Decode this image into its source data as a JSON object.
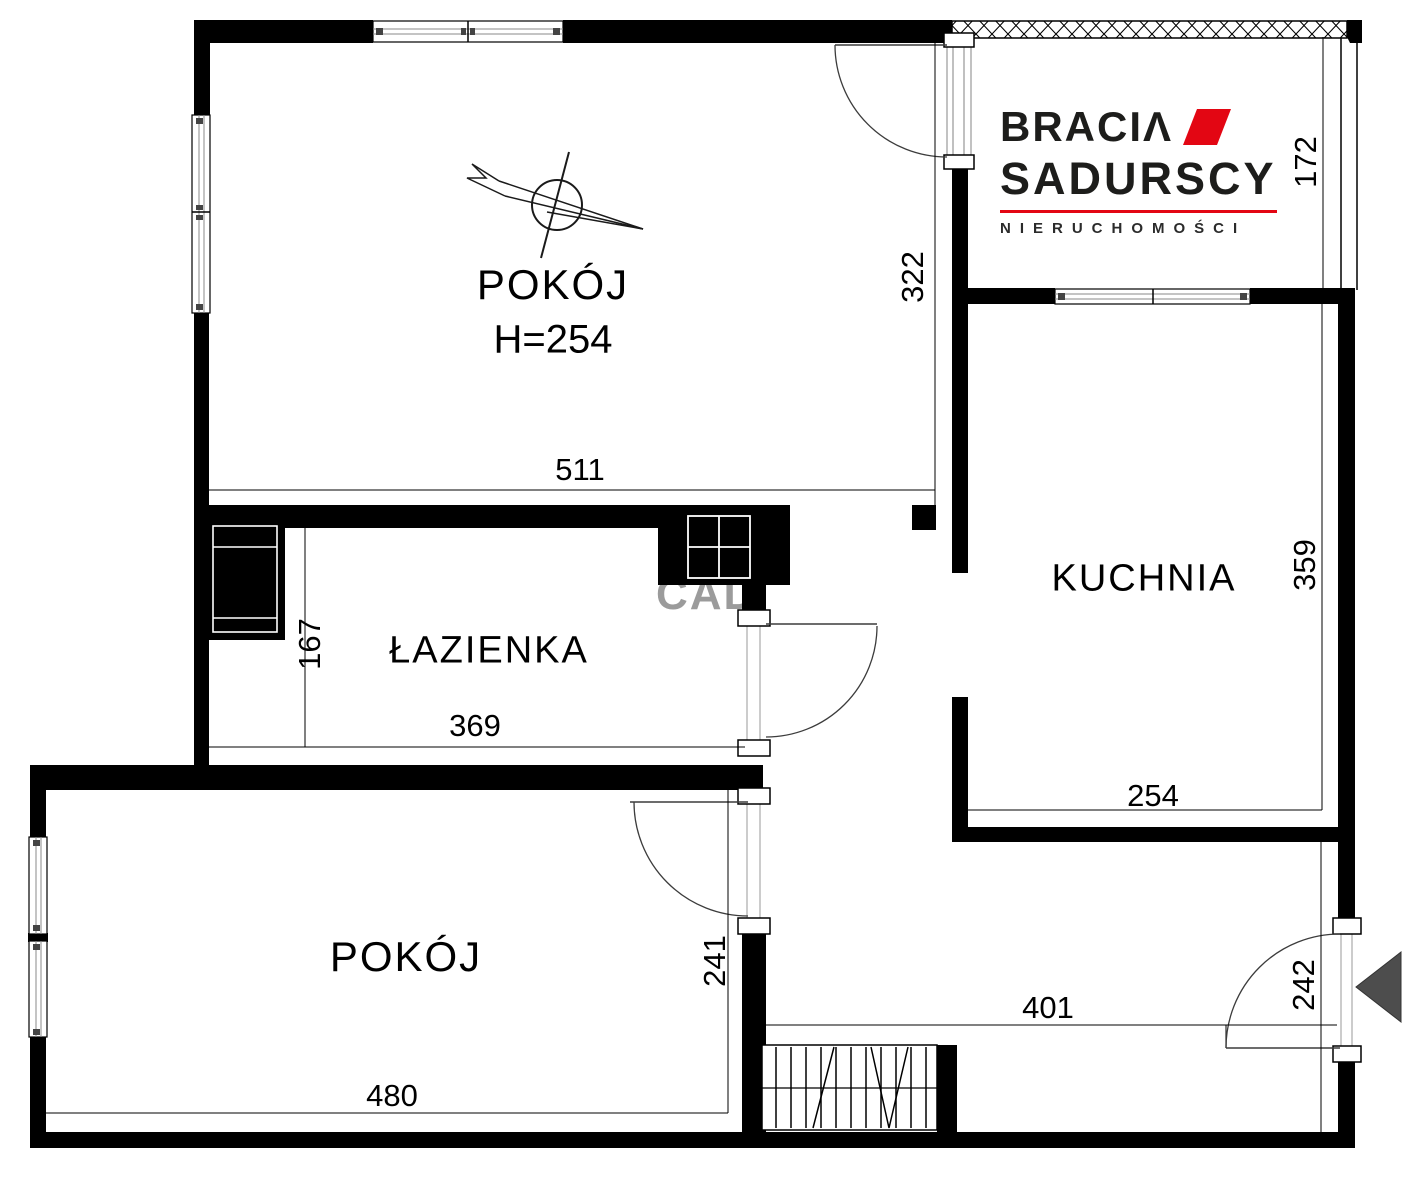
{
  "watermark": {
    "text": "CAD"
  },
  "logo": {
    "brand_line1": "BRACIΛ",
    "brand_line2": "SADURSCY",
    "tagline": "NIERUCHOMOŚCI",
    "accent_color": "#e30613"
  },
  "rooms": {
    "top_room": {
      "label": "POKÓJ",
      "ceiling_height": "H=254"
    },
    "bathroom": {
      "label": "ŁAZIENKA"
    },
    "kitchen": {
      "label": "KUCHNIA"
    },
    "bottom_room": {
      "label": "POKÓJ"
    }
  },
  "dimensions_cm": {
    "top_room_width": "511",
    "top_room_depth": "322",
    "balcony_depth": "172",
    "kitchen_depth": "359",
    "kitchen_width": "254",
    "bathroom_width": "369",
    "bathroom_depth": "167",
    "hall_door_depth": "241",
    "hall_width": "401",
    "bottom_room_width": "480",
    "entrance_wall": "242"
  },
  "colors": {
    "wall": "#000000",
    "thin_line": "#000000",
    "door_swing": "#3c3c3c",
    "window_rail": "#888888",
    "logo_red": "#e30613",
    "entrance_arrow": "#4d4d4d",
    "watermark_gray": "#9b9b9b"
  }
}
